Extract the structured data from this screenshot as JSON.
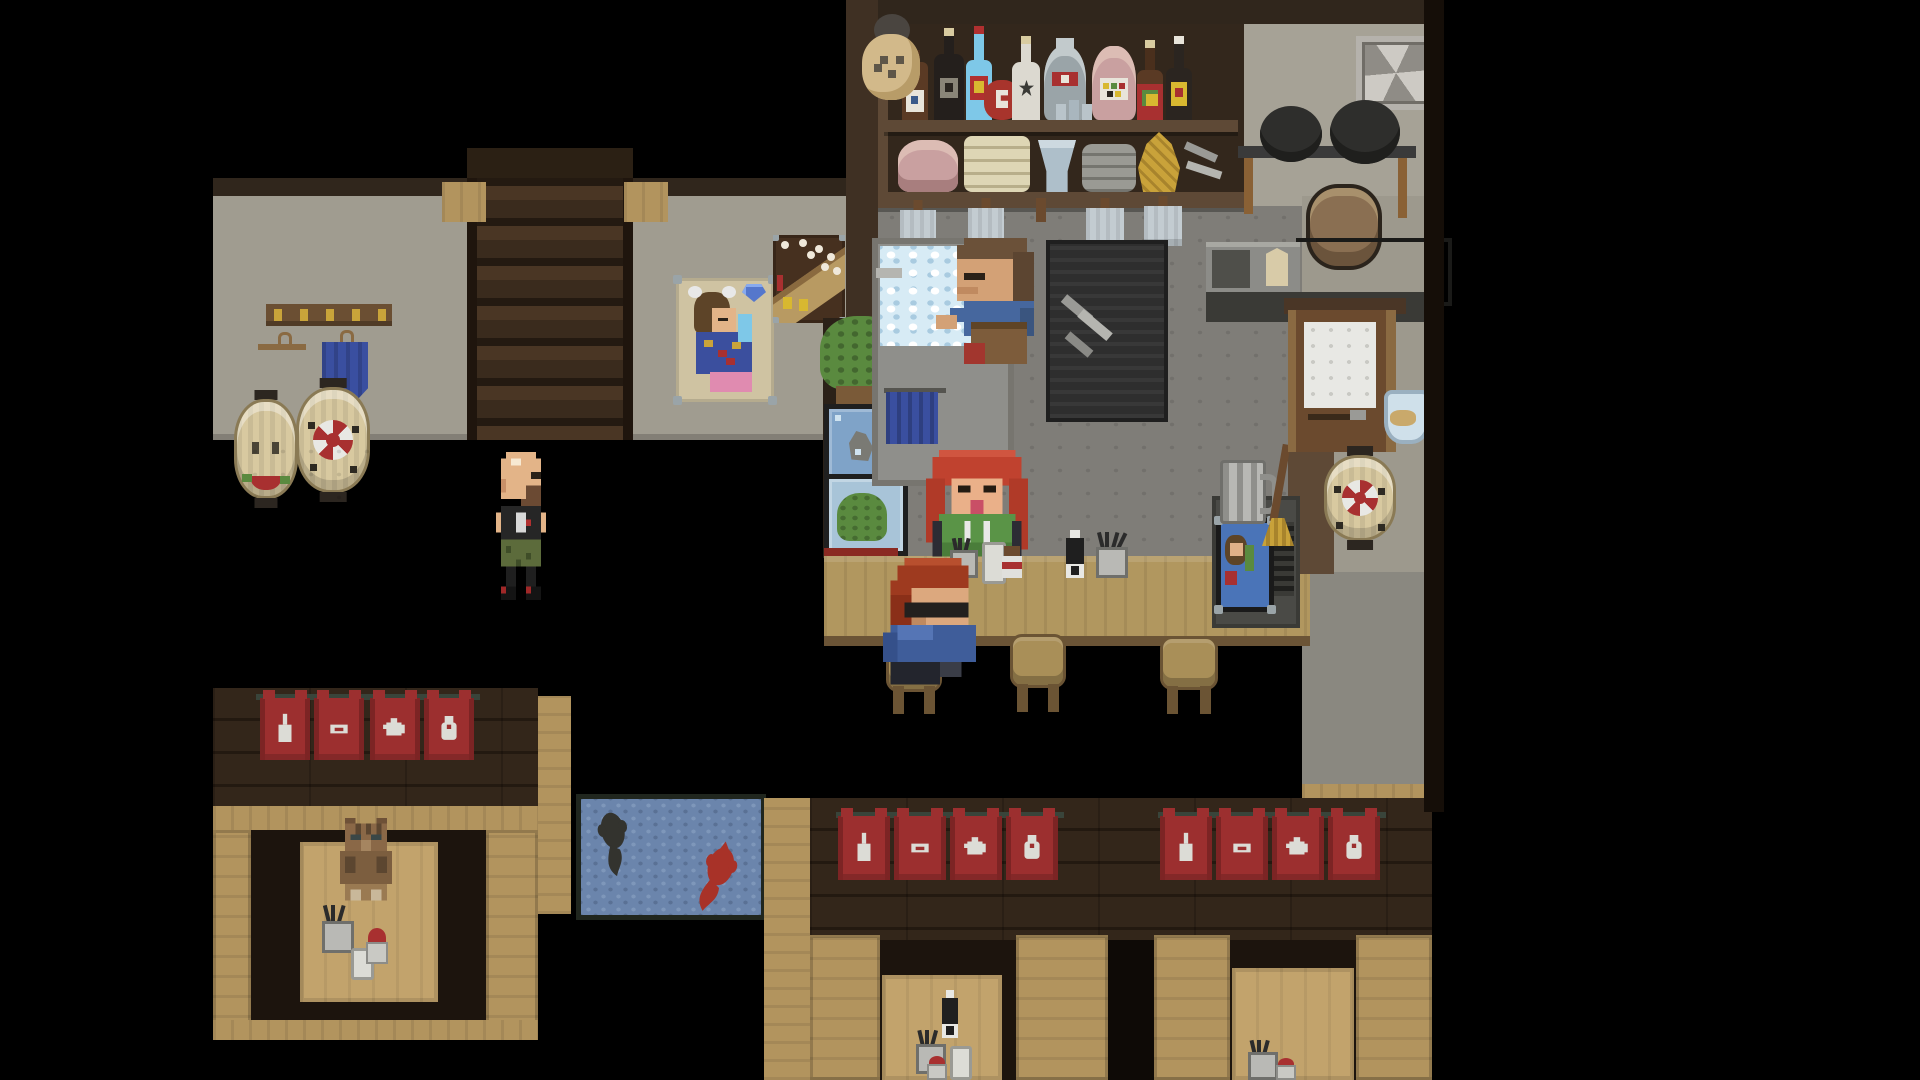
{
  "scene": {
    "title": "Pixel-art izakaya tavern interior",
    "description": "Top-down pixel-art bar scene with bartender washing dishes, red-haired server at the counter, seated customer, bald patron, cat in a booth, red noren banners and a blue koi rug"
  },
  "palette": {
    "black": "#000000",
    "woodFloor": "#3c2c1e",
    "woodLine": "#281c11",
    "woodDark": "#33261a",
    "brickLine": "#231910",
    "tanWood": "#b2945e",
    "tableTan": "#c2a36c",
    "counterTan": "#b1975f",
    "counterEdge": "#6b5436",
    "wallGray": "#a09c90",
    "kitchenWall": "#a6a296",
    "concrete": "#7f7d78",
    "rightWall": "#9d998d",
    "rightFloor": "#8a8880",
    "bannerRed": "#9c2f2f",
    "bannerDark": "#7c2424",
    "iconWhite": "#dcdcd6",
    "matBlue": "#6b85ac",
    "matDot1": "#7e97ba",
    "matDot2": "#5a7195",
    "matBorder": "#20261e",
    "sinkGray": "#8f8f8b",
    "foamBase": "#d7ebf5",
    "dishRack": "#2e2e2e",
    "stoveBlack": "#262624",
    "metalGray": "#8c8c88",
    "doorBrown": "#6b4a2e",
    "doorFrame": "#8a6a42",
    "windowWhite": "#e8e8e4",
    "lanternCream": "#d8c9a0",
    "capDark": "#2c2620",
    "accentRed": "#a83030",
    "leafGreen": "#5a8a3f",
    "stoolTan": "#a98f58",
    "stoolEdge": "#6b5434",
    "gold": "#c9a43a",
    "clothBlue": "#3a4fa0",
    "posterBeige": "#cfc3a2",
    "posterBrown": "#46301f",
    "waveTan": "#b89a62",
    "glassBlue": "#7fa3c8",
    "glassLight": "#a8c4d8",
    "mugGray": "#b8b8b4",
    "panBlack": "#2e2e2c",
    "fanGray": "#b5b2ac",
    "beamDark": "#30261c",
    "beamBrown": "#5e4936",
    "shelfBack": "#33271c",
    "railGreen": "#39443a"
  },
  "characters": {
    "bartender": {
      "title": "Bartender washing dishes at the sink",
      "hair": "#6b5139",
      "shirt": "#46679e",
      "apron": "#7d5c3b"
    },
    "server": {
      "title": "Red-haired server in green hoodie",
      "hair": "#c0422f",
      "hoodie": "#5a9447"
    },
    "customer": {
      "title": "Seated customer with glasses and blue jacket",
      "hair": "#9e3a1f",
      "jacket": "#3f5d9a"
    },
    "patron": {
      "title": "Bald patron in black t-shirt and camo shorts",
      "shirt": "#262626",
      "shorts": "#5c6b3b"
    },
    "cat": {
      "title": "Brown tabby cat sitting in the booth"
    }
  },
  "props": {
    "shelf": {
      "title": "Bar shelf with sake bottles and stacked dishes",
      "bottles": [
        "hanging gourd lantern",
        "brown bottle with label",
        "black sake bottle",
        "blue bottle",
        "red sake jug",
        "white sake bottle",
        "gray flask with red seal",
        "three sake cups",
        "pink round jar",
        "red-wrapped bottle",
        "dark bottle with yellow label"
      ],
      "dishes": [
        "pink bowl stack",
        "cream plate stack",
        "blue bowls",
        "gray plates",
        "yellow basket",
        "ladles"
      ]
    },
    "kitchen": {
      "fan": "ventilation fan",
      "potRack": "pot rack with two black pans",
      "stove": "stove with pot and griddle",
      "towels": "hanging towels under shelf"
    },
    "bar": {
      "sink": "sink full of soapy suds",
      "dishRack": "dish drying rack",
      "counter": "wooden bar counter",
      "counterItems": [
        "chopstick cup",
        "white bottle",
        "condiment jar",
        "soy sauce bottle",
        "chopstick cup"
      ],
      "stools": "wooden bar stools",
      "mug": "glass beer mug",
      "picture": "framed pin-up picture",
      "broom": "broom"
    },
    "leftRoom": {
      "stairs": "staircase to upper floor",
      "coatRack": "coat rack with gold hooks",
      "cloth": "blue cloth on hanger",
      "lanterns": [
        "paper lantern with face design",
        "paper lantern with red pinwheel flower"
      ],
      "posters": {
        "pinup": "pin-up girl poster",
        "wave": "wave poster"
      },
      "plant": "potted plant",
      "tanks": [
        "aquarium with rock",
        "terrarium with plant"
      ]
    },
    "door": {
      "title": "Back door with frosted window",
      "fishbowl": "fishbowl beside door",
      "lantern": "paper lantern with red flower"
    },
    "mat": {
      "title": "Blue koi fish rug",
      "fish": [
        "black koi",
        "red koi"
      ]
    },
    "banners": {
      "title": "Red noren banners",
      "icons": [
        "sake bottle",
        "plate",
        "teapot",
        "sake cup"
      ]
    },
    "booths": {
      "title": "Booth seating with low tables",
      "tableItems": [
        "soy sauce bottle",
        "chopstick cup",
        "red condiment jar",
        "white cup"
      ]
    }
  }
}
